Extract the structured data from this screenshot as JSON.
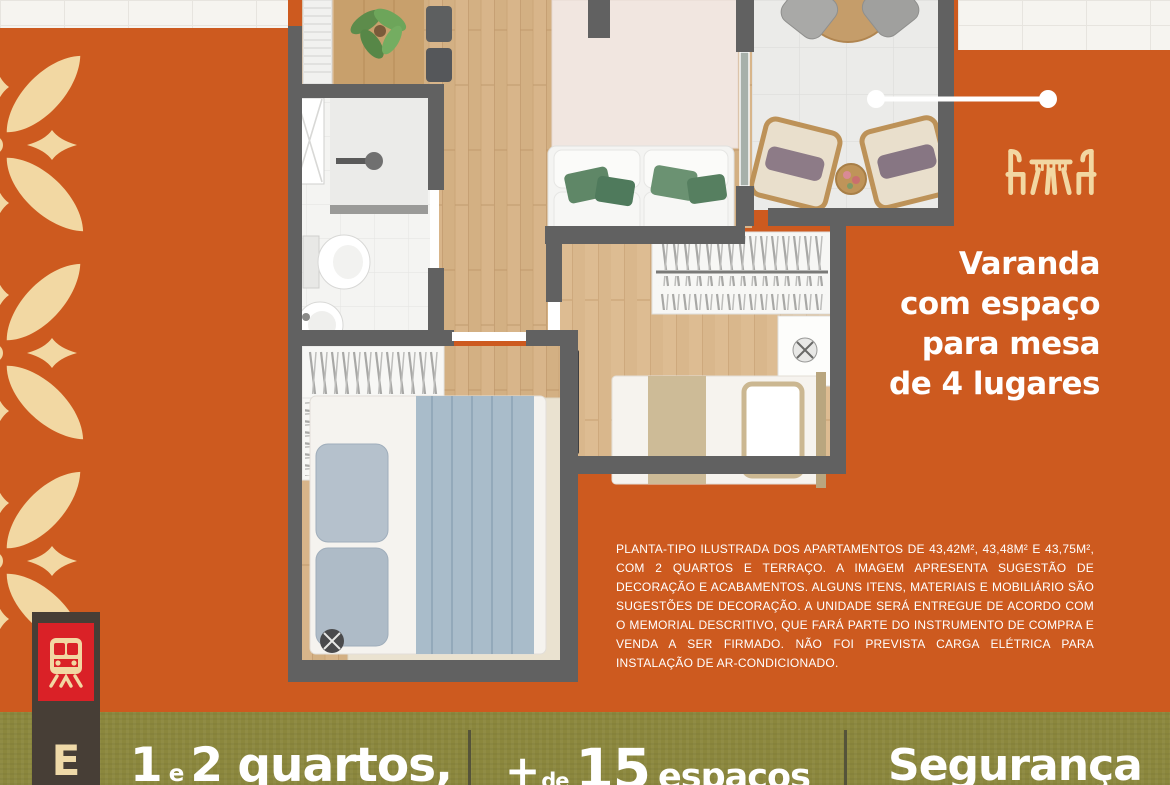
{
  "palette": {
    "background_orange": "#cd5a1f",
    "cream_accent": "#f2d7a2",
    "olive_bar": "#8b873d",
    "rail_brown": "#473e36",
    "badge_red": "#da2127",
    "wall_gray": "#616161",
    "text_white": "#ffffff"
  },
  "callout": {
    "icon": "table-with-chairs-icon",
    "lines": [
      "Varanda",
      "com espaço",
      "para mesa",
      "de 4 lugares"
    ]
  },
  "disclaimer": {
    "text": "PLANTA-TIPO ILUSTRADA DOS APARTAMENTOS DE 43,42M², 43,48M² E 43,75M², COM 2 QUARTOS E TERRAÇO. A IMAGEM APRESENTA SUGESTÃO DE DECORAÇÃO E ACABAMENTOS. ALGUNS ITENS, MATERIAIS E MOBILIÁRIO SÃO SUGESTÕES DE DECORAÇÃO. A UNIDADE SERÁ ENTREGUE DE ACORDO COM O MEMORIAL DESCRITIVO, QUE FARÁ PARTE DO INSTRUMENTO DE COMPRA E VENDA A SER FIRMADO. NÃO FOI PREVISTA CARGA ELÉTRICA PARA INSTALAÇÃO DE AR-CONDICIONADO."
  },
  "features_bar": {
    "item1": {
      "num1": "1",
      "conj": "e",
      "rest": "2 quartos,"
    },
    "item2": {
      "plus": "+",
      "de": "de",
      "num": "15",
      "word": "espaços"
    },
    "item3": {
      "label": "Segurança"
    }
  },
  "transit_rail": {
    "icon": "train-icon",
    "letter": "E"
  }
}
